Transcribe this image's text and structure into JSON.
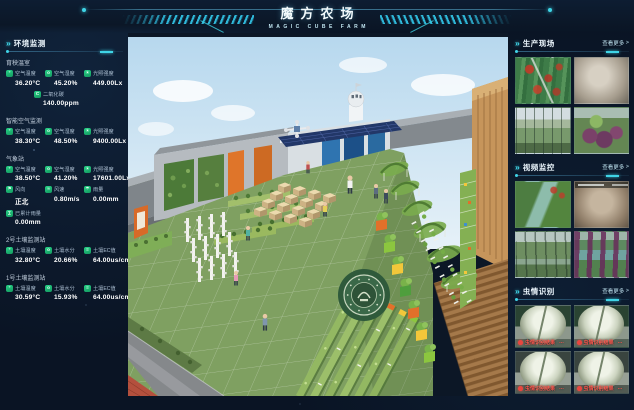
{
  "header": {
    "title": "魔方农场",
    "subtitle": "MAGIC CUBE FARM"
  },
  "left_panel": {
    "title": "环境监测",
    "sections": [
      {
        "name": "育秧温室",
        "metrics": [
          {
            "icon": "thermometer-icon",
            "label": "空气温度",
            "value": "36.20°C"
          },
          {
            "icon": "humidity-icon",
            "label": "空气湿度",
            "value": "45.20%"
          },
          {
            "icon": "light-icon",
            "label": "光照强度",
            "value": "449.00Lx"
          },
          {
            "icon": "co2-icon",
            "label": "二氧化碳",
            "value": "140.00ppm"
          }
        ]
      },
      {
        "name": "智能空气监测",
        "metrics": [
          {
            "icon": "thermometer-icon",
            "label": "空气温度",
            "value": "38.30°C"
          },
          {
            "icon": "humidity-icon",
            "label": "空气湿度",
            "value": "48.50%"
          },
          {
            "icon": "light-icon",
            "label": "光照强度",
            "value": "9400.00Lx"
          }
        ]
      },
      {
        "name": "气象站",
        "metrics": [
          {
            "icon": "thermometer-icon",
            "label": "空气温度",
            "value": "38.50°C"
          },
          {
            "icon": "humidity-icon",
            "label": "空气湿度",
            "value": "41.20%"
          },
          {
            "icon": "light-icon",
            "label": "光照强度",
            "value": "17601.00Lx"
          },
          {
            "icon": "wind-direction-icon",
            "label": "风向",
            "value": "正北"
          },
          {
            "icon": "wind-speed-icon",
            "label": "风速",
            "value": "0.80m/s"
          },
          {
            "icon": "rain-icon",
            "label": "雨量",
            "value": "0.00mm"
          },
          {
            "icon": "rain-total-icon",
            "label": "已累计雨量",
            "value": "0.00mm"
          }
        ]
      },
      {
        "name": "2号土壤监测站",
        "metrics": [
          {
            "icon": "soil-temp-icon",
            "label": "土壤温度",
            "value": "32.80°C"
          },
          {
            "icon": "soil-moisture-icon",
            "label": "土壤水分",
            "value": "20.66%"
          },
          {
            "icon": "soil-ec-icon",
            "label": "土壤EC值",
            "value": "64.00us/cm"
          }
        ]
      },
      {
        "name": "1号土壤监测站",
        "metrics": [
          {
            "icon": "soil-temp-icon",
            "label": "土壤温度",
            "value": "30.59°C"
          },
          {
            "icon": "soil-moisture-icon",
            "label": "土壤水分",
            "value": "15.93%"
          },
          {
            "icon": "soil-ec-icon",
            "label": "土壤EC值",
            "value": "64.00us/cm"
          }
        ]
      }
    ]
  },
  "right_panel": {
    "sections": [
      {
        "title": "生产现场",
        "more_label": "查看更多",
        "more_arrow": ">",
        "cameras": [
          "vine-wall-cam",
          "defocused-cam",
          "greenhouse-shelf-cam",
          "purple-crop-cam"
        ]
      },
      {
        "title": "视频监控",
        "more_label": "查看更多",
        "more_arrow": ">",
        "cameras": [
          "aerial-path-cam",
          "defocused-cam",
          "corridor-cam",
          "purple-row-cam"
        ]
      },
      {
        "title": "虫情识别",
        "more_label": "查看更多",
        "more_arrow": ">",
        "alert_label": "虫情识别结果",
        "alert_ellipsis": "…",
        "trap_count": 4
      }
    ]
  },
  "main_view": {
    "kind": "3d-farm-scene"
  },
  "colors": {
    "accent": "#3fd4e6",
    "icon_green": "#1fbf75",
    "alert_red": "#e8463f",
    "background": "#0a1424",
    "value_text": "#ffffff"
  }
}
